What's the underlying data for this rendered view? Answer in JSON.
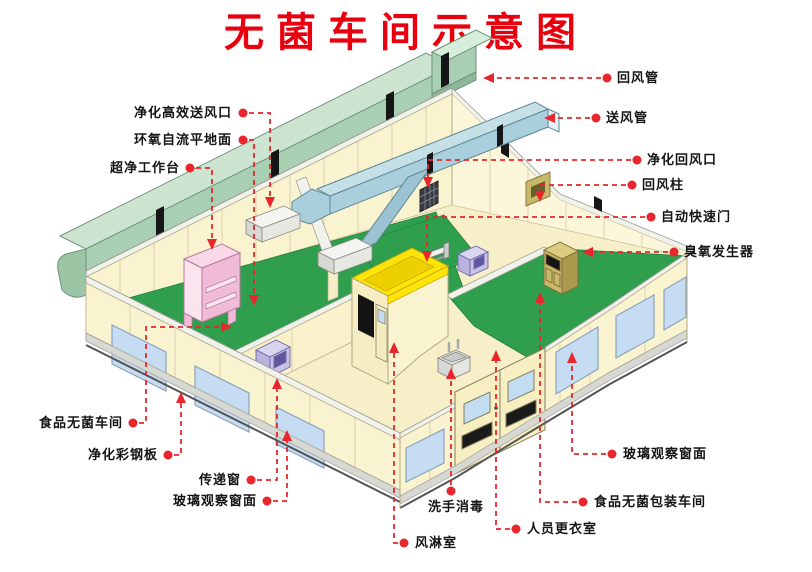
{
  "title": "无菌车间示意图",
  "diagram_type": "isometric cutaway schematic of a sterile food workshop (cleanroom)",
  "labels": {
    "hepa_supply_outlet": "净化高效送风口",
    "epoxy_floor": "环氧自流平地面",
    "clean_workbench": "超净工作台",
    "return_air_duct": "回风管",
    "supply_air_duct": "送风管",
    "purify_return_air_vent": "净化回风口",
    "return_air_column": "回风柱",
    "auto_rapid_door": "自动快速门",
    "ozone_generator": "臭氧发生器",
    "food_sterile_workshop": "食品无菌车间",
    "purify_steel_panel": "净化彩钢板",
    "transfer_window": "传递窗",
    "glass_observation_window_left": "玻璃观察窗面",
    "glass_observation_window_right": "玻璃观察窗面",
    "air_shower_room": "风淋室",
    "hand_wash_disinfect": "洗手消毒",
    "staff_changing_room": "人员更衣室",
    "food_sterile_packaging_workshop": "食品无菌包装车间"
  },
  "colors": {
    "title_red": "#E8000F",
    "leader_red": "#E8262B",
    "floor_green": "#2F9E4D",
    "wall_cream": "#FAF3CF",
    "return_duct_teal": "#A9CFB2",
    "supply_duct_blue": "#A9CFDC",
    "air_shower_yellow": "#FFE40A",
    "workbench_pink": "#F3C5DC",
    "transfer_box_lavender": "#C7C1E6",
    "ozone_cabinet_tan": "#C9B96B",
    "window_glass_blue": "#C5DCF2"
  }
}
